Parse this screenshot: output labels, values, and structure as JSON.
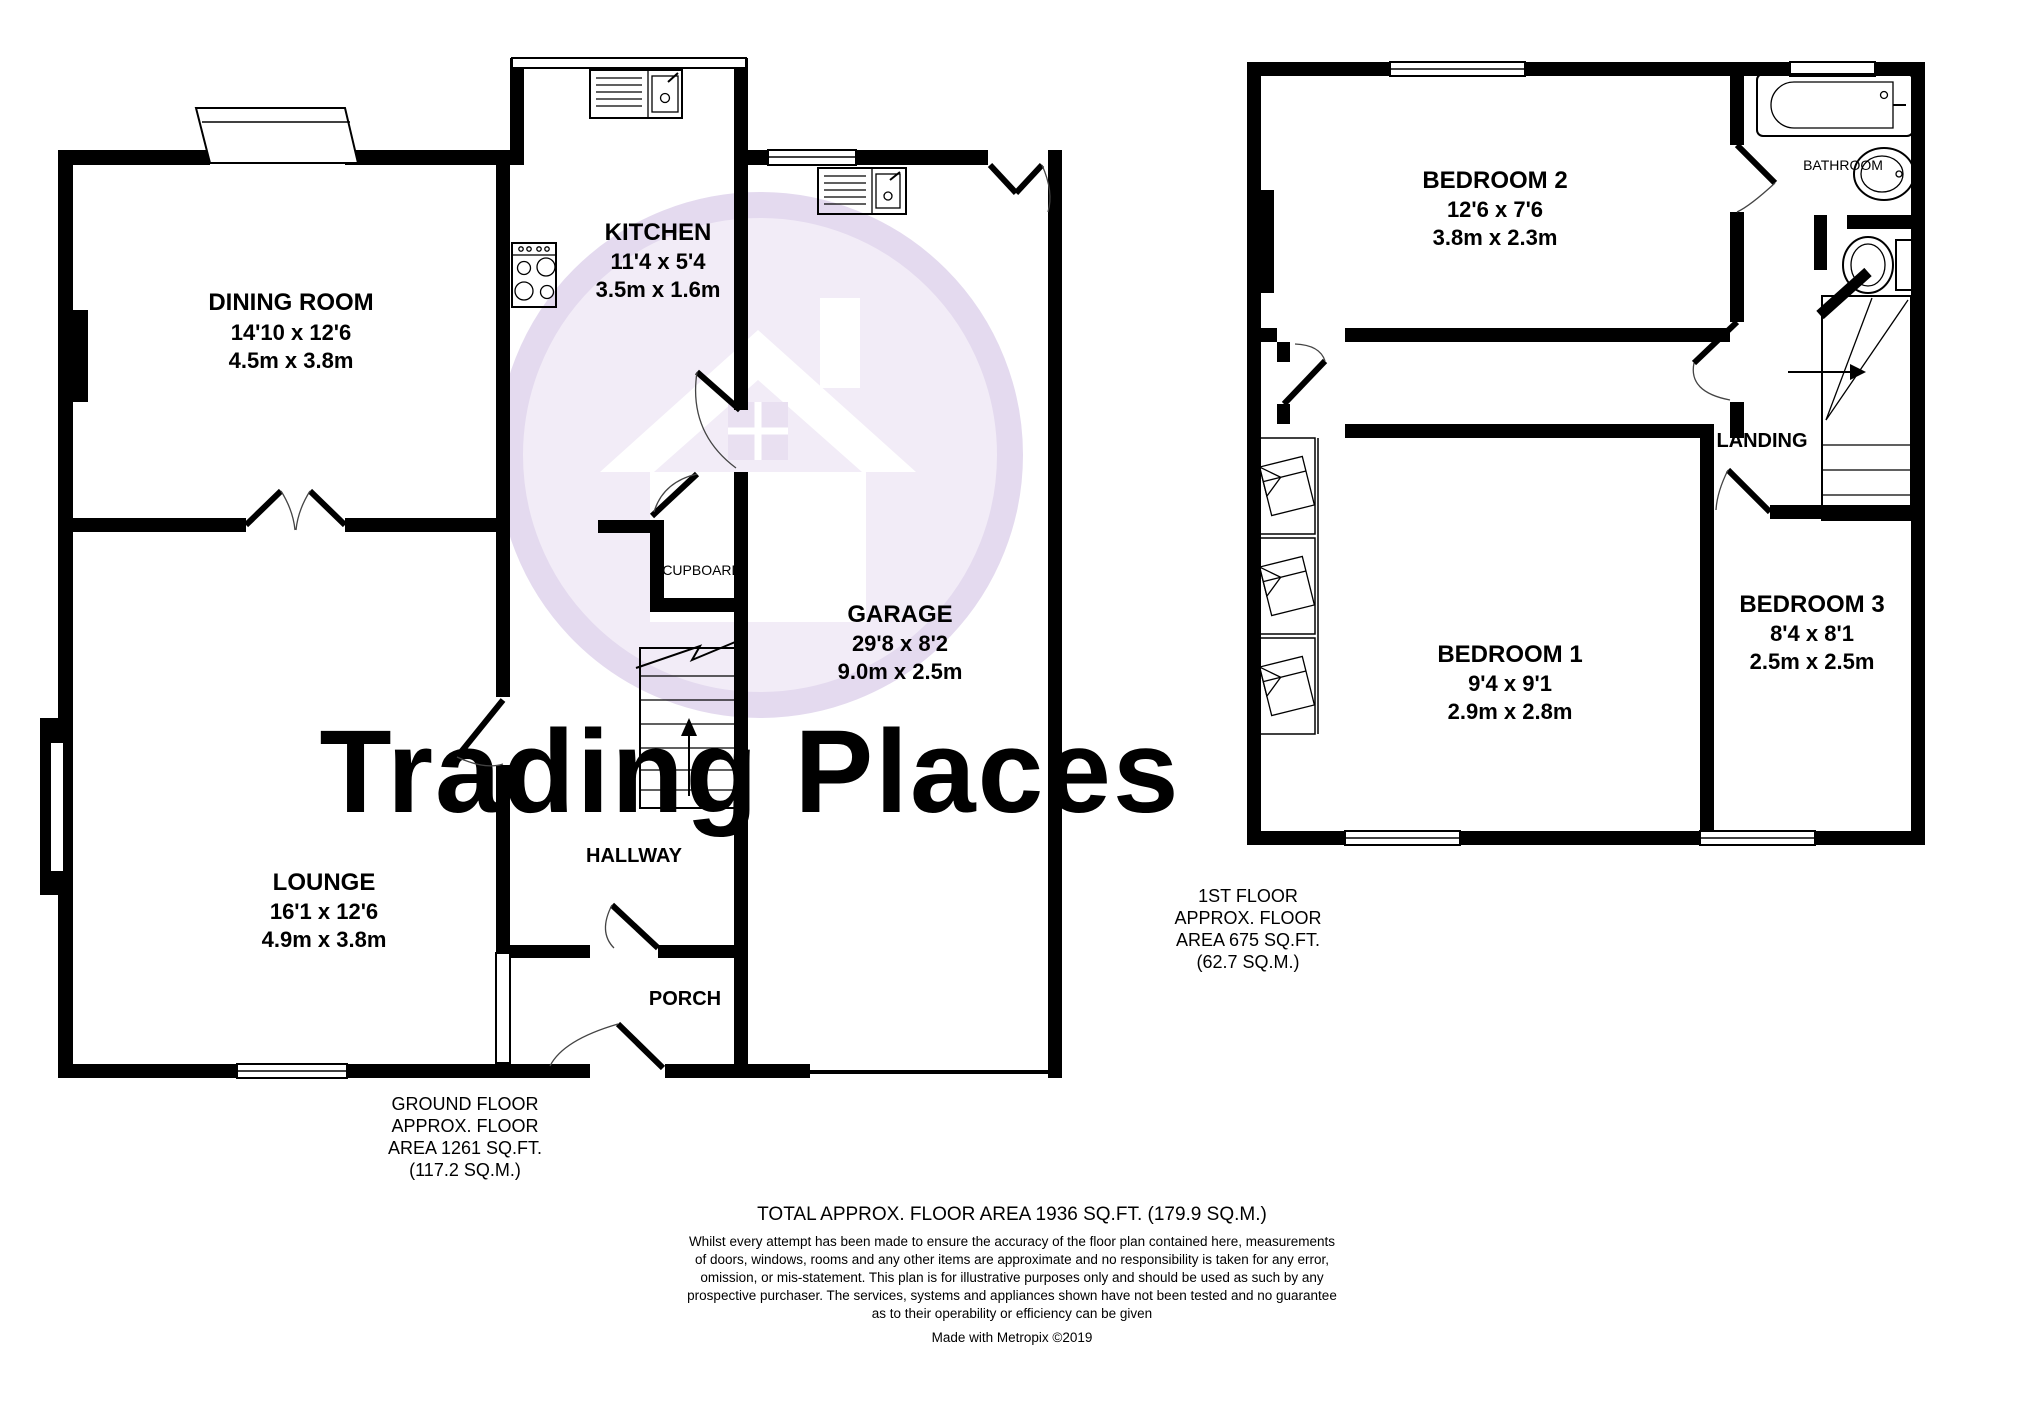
{
  "watermark": {
    "brand": "Trading Places",
    "logo": "house-in-circle",
    "color": "#e2cede"
  },
  "colors": {
    "walls": "#000000",
    "watermark_circle": "#e4daef",
    "watermark_fill": "#f2ecf7"
  },
  "ground_floor": {
    "caption": [
      "GROUND FLOOR",
      "APPROX. FLOOR",
      "AREA 1261 SQ.FT.",
      "(117.2 SQ.M.)"
    ],
    "rooms": {
      "dining": {
        "name": "DINING ROOM",
        "imperial": "14'10 x 12'6",
        "metric": "4.5m x 3.8m"
      },
      "kitchen": {
        "name": "KITCHEN",
        "imperial": "11'4 x 5'4",
        "metric": "3.5m x 1.6m"
      },
      "garage": {
        "name": "GARAGE",
        "imperial": "29'8 x 8'2",
        "metric": "9.0m x 2.5m"
      },
      "lounge": {
        "name": "LOUNGE",
        "imperial": "16'1 x 12'6",
        "metric": "4.9m x 3.8m"
      },
      "hallway": {
        "name": "HALLWAY"
      },
      "porch": {
        "name": "PORCH"
      },
      "cupboard": {
        "name": "CUPBOARD"
      }
    }
  },
  "first_floor": {
    "caption": [
      "1ST FLOOR",
      "APPROX. FLOOR",
      "AREA 675 SQ.FT.",
      "(62.7 SQ.M.)"
    ],
    "rooms": {
      "bedroom2": {
        "name": "BEDROOM 2",
        "imperial": "12'6 x 7'6",
        "metric": "3.8m x 2.3m"
      },
      "bedroom1": {
        "name": "BEDROOM 1",
        "imperial": "9'4 x 9'1",
        "metric": "2.9m x 2.8m"
      },
      "bedroom3": {
        "name": "BEDROOM 3",
        "imperial": "8'4 x 8'1",
        "metric": "2.5m x 2.5m"
      },
      "bathroom": {
        "name": "BATHROOM"
      },
      "landing": {
        "name": "LANDING"
      }
    }
  },
  "footer": {
    "total": "TOTAL APPROX. FLOOR AREA 1936 SQ.FT. (179.9 SQ.M.)",
    "disclaimer": [
      "Whilst every attempt has been made to ensure the accuracy of the floor plan contained here, measurements",
      "of doors, windows, rooms and any other items are approximate and no responsibility is taken for any error,",
      "omission, or mis-statement. This plan is for illustrative purposes only and should be used as such by any",
      "prospective purchaser. The services, systems and appliances shown have not been tested and no guarantee",
      "as to their operability or efficiency can be given"
    ],
    "credit": "Made with Metropix ©2019"
  }
}
